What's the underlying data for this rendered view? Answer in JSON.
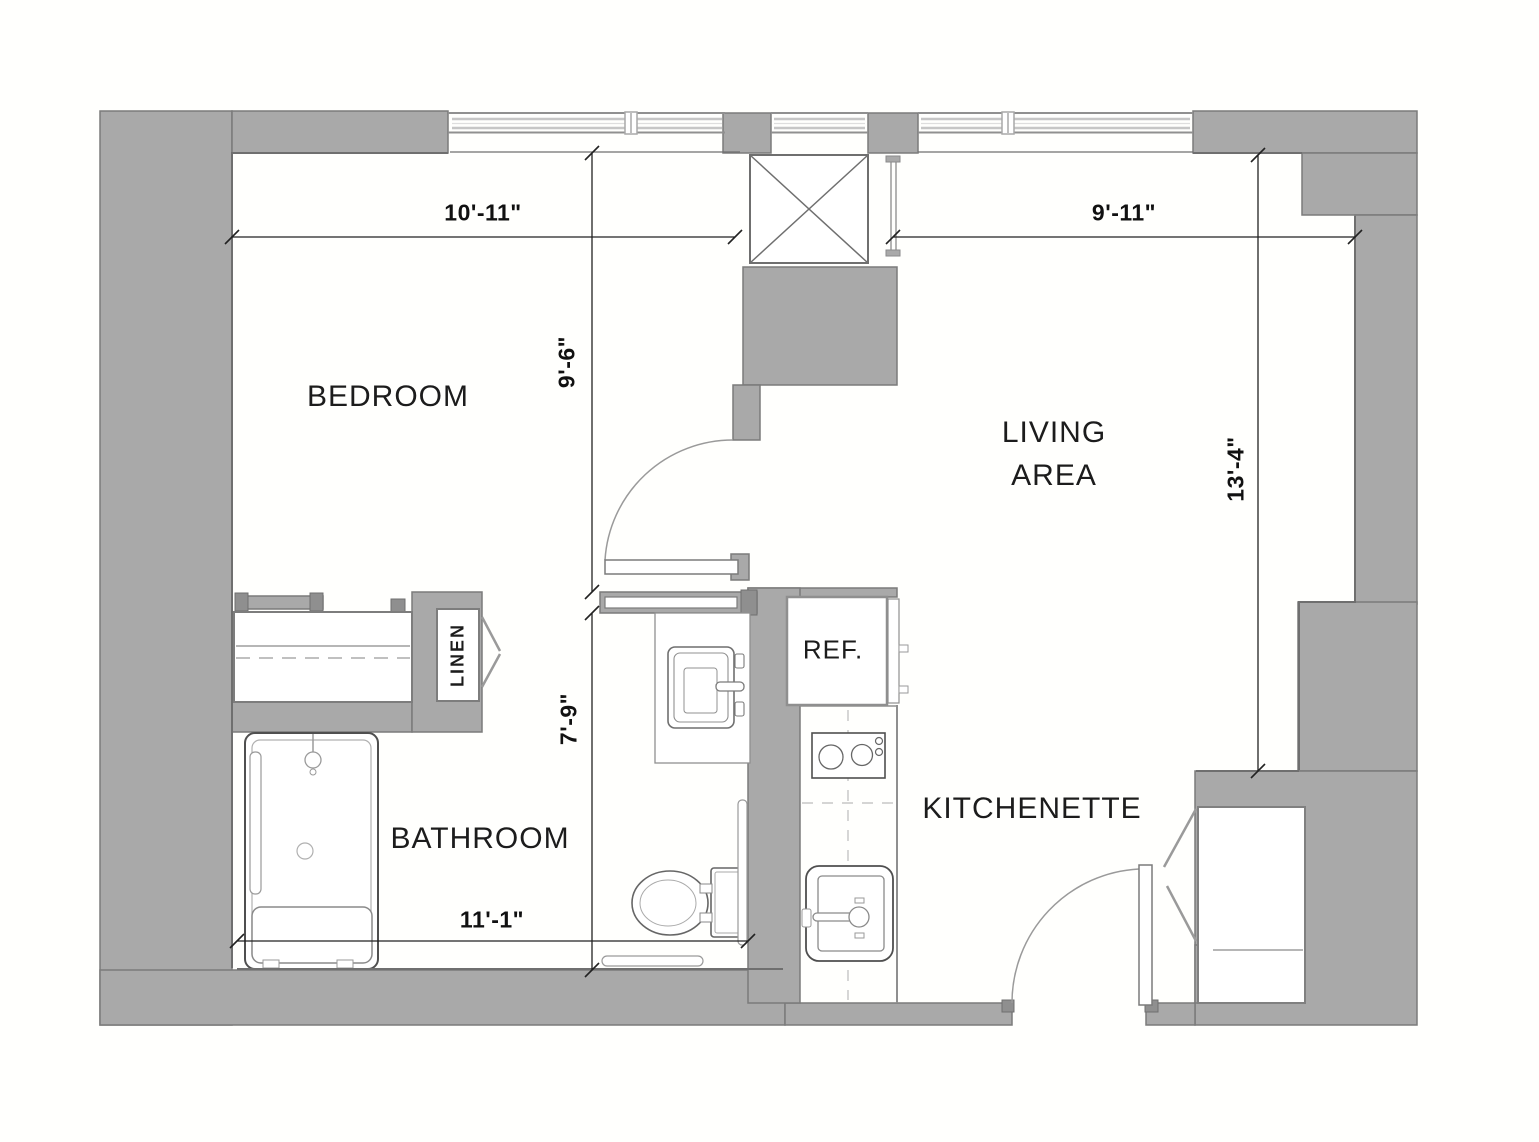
{
  "title": "One-bedroom apartment floor plan",
  "rooms": {
    "bedroom": {
      "label": "BEDROOM"
    },
    "living": {
      "label": "LIVING AREA",
      "line1": "LIVING",
      "line2": "AREA"
    },
    "bathroom": {
      "label": "BATHROOM"
    },
    "kitchenette": {
      "label": "KITCHENETTE"
    },
    "linen": {
      "label": "LINEN"
    },
    "refrigerator": {
      "label": "REF."
    }
  },
  "dimensions": {
    "bedroom_width": "10'-11\"",
    "living_width": "9'-11\"",
    "bedroom_depth": "9'-6\"",
    "bathroom_depth": "7'-9\"",
    "living_depth": "13'-4\"",
    "bathroom_width": "11'-1\""
  },
  "fixtures": [
    "shower-with-bench",
    "toilet",
    "vanity-sink",
    "grab-bars",
    "wardrobe-closet",
    "linen-closet-bifold",
    "refrigerator",
    "cooktop-two-burner",
    "kitchen-sink",
    "kitchen-counter",
    "entry-door",
    "hall-door",
    "bathroom-sliding-door",
    "entry-closet-bifold",
    "elevator-shaft",
    "windows"
  ],
  "colors": {
    "wall_fill": "#a9a9a9",
    "wall_edge": "#7b7b7b",
    "fixture_dark": "#4f4f4f",
    "fixture_mid": "#8a8a8a",
    "fixture_light": "#b5b5b5",
    "dimension_line": "#222222",
    "text": "#1c1c1c",
    "background": "#fffffd"
  }
}
